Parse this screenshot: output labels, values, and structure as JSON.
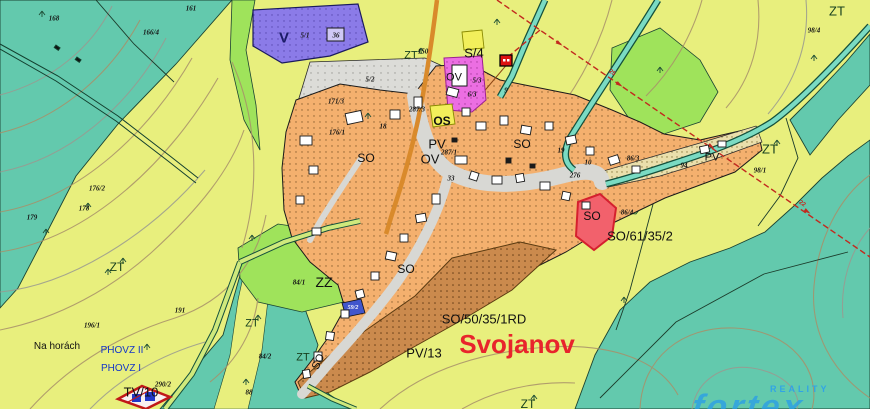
{
  "town_label": {
    "text": "Svojanov"
  },
  "zone_labels": [
    {
      "text": "S/4"
    },
    {
      "text": "ZT"
    },
    {
      "text": "ZT"
    },
    {
      "text": "ZT"
    },
    {
      "text": "ZT"
    },
    {
      "text": "ZT"
    },
    {
      "text": "ZT"
    },
    {
      "text": "ZT"
    },
    {
      "text": "ZZ"
    },
    {
      "text": "SO"
    },
    {
      "text": "SO"
    },
    {
      "text": "SO"
    },
    {
      "text": "SO"
    },
    {
      "text": "SO"
    },
    {
      "text": "PV"
    },
    {
      "text": "PV"
    },
    {
      "text": "OV"
    },
    {
      "text": "OV"
    },
    {
      "text": "OS"
    },
    {
      "text": "PV/13"
    },
    {
      "text": "TV/10"
    },
    {
      "text": "SO/61/35/2"
    },
    {
      "text": "SO/50/35/1RD"
    },
    {
      "text": "V"
    },
    {
      "text": "Na horách"
    },
    {
      "text": "PHOVZ II"
    },
    {
      "text": "PHOVZ I"
    }
  ],
  "parcel_labels": [
    {
      "text": "168"
    },
    {
      "text": "161"
    },
    {
      "text": "166/4"
    },
    {
      "text": "150"
    },
    {
      "text": "5/1"
    },
    {
      "text": "36"
    },
    {
      "text": "5/2"
    },
    {
      "text": "5/3"
    },
    {
      "text": "6/3"
    },
    {
      "text": "9"
    },
    {
      "text": "171/3"
    },
    {
      "text": "176/1"
    },
    {
      "text": "287/3"
    },
    {
      "text": "287/1"
    },
    {
      "text": "18"
    },
    {
      "text": "19"
    },
    {
      "text": "10"
    },
    {
      "text": "276"
    },
    {
      "text": "94"
    },
    {
      "text": "33"
    },
    {
      "text": "86/3"
    },
    {
      "text": "86/4"
    },
    {
      "text": "98/4"
    },
    {
      "text": "98/1"
    },
    {
      "text": "178"
    },
    {
      "text": "179"
    },
    {
      "text": "176/2"
    },
    {
      "text": "191"
    },
    {
      "text": "196/1"
    },
    {
      "text": "84/1"
    },
    {
      "text": "84/2"
    },
    {
      "text": "88"
    },
    {
      "text": "290/2"
    },
    {
      "text": "59/2"
    }
  ],
  "route_labels": [
    {
      "text": "25"
    },
    {
      "text": "22"
    }
  ],
  "watermark": {
    "reality": "REALITY",
    "brand": "fortex"
  },
  "colors": {
    "meadow_base": "#E8EF7D",
    "forest_teal": "#63C9AD",
    "garden_green": "#9FE35B",
    "village_orange": "#F4B06E",
    "road_gray": "#D8D8D4",
    "industry_purple": "#8B7BE8",
    "civic_magenta": "#EC6EE2",
    "sport_yellow": "#F2EF5B",
    "develop_red": "#F2616C",
    "develop_brown": "#CB8A4D",
    "town_label_red": "#E8242C",
    "watermark_blue": "#2FA3E8"
  }
}
